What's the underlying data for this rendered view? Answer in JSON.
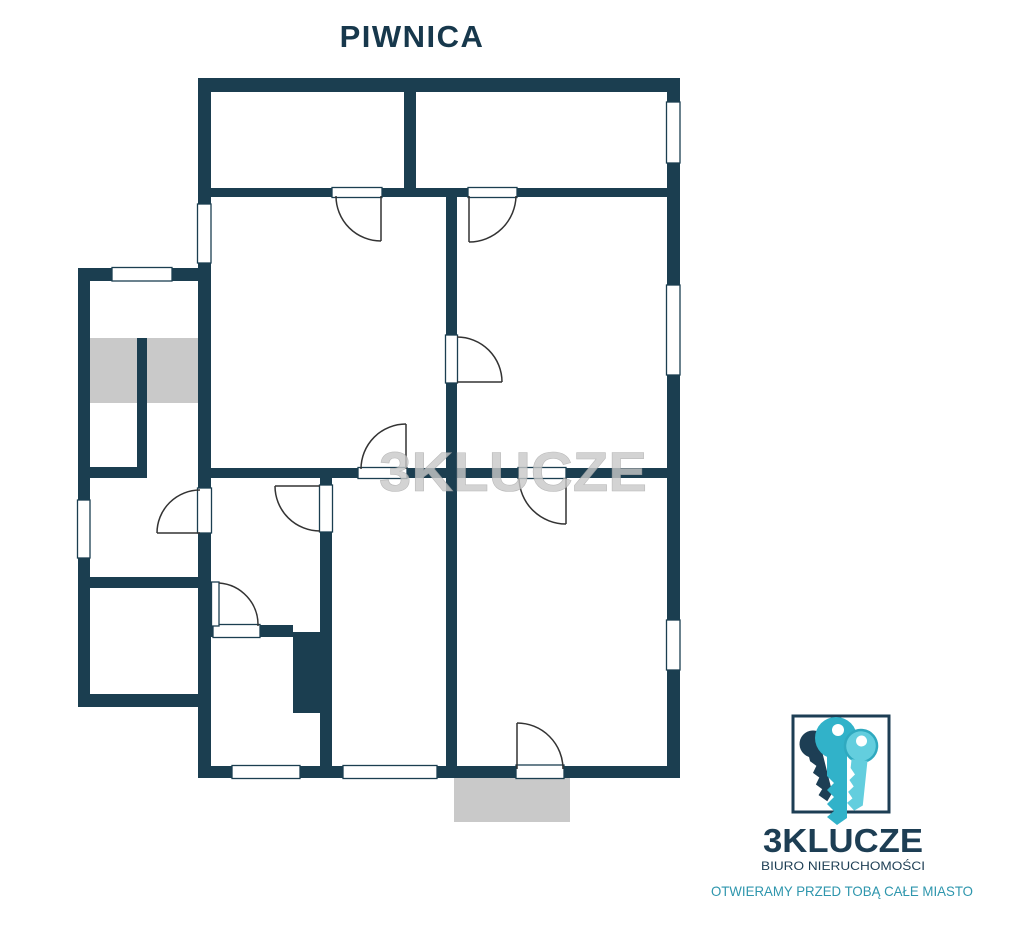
{
  "header": {
    "title": "PIWNICA"
  },
  "watermark": {
    "text": "3KLUCZE"
  },
  "logo": {
    "brand": "3KLUCZE",
    "subtitle": "BIURO NIERUCHOMOŚCI",
    "tagline": "OTWIERAMY PRZED TOBĄ CAŁE MIASTO"
  },
  "colors": {
    "background": "#ffffff",
    "title_text": "#17384c",
    "wall": "#1b3e50",
    "door_line": "#333333",
    "gray_area": "#c9c9c9",
    "watermark_text": "#c9c9c9",
    "logo_dark": "#1d3e54",
    "logo_key_teal": "#31b2c9",
    "logo_key_light": "#63cede",
    "logo_tagline": "#2e96ad"
  }
}
